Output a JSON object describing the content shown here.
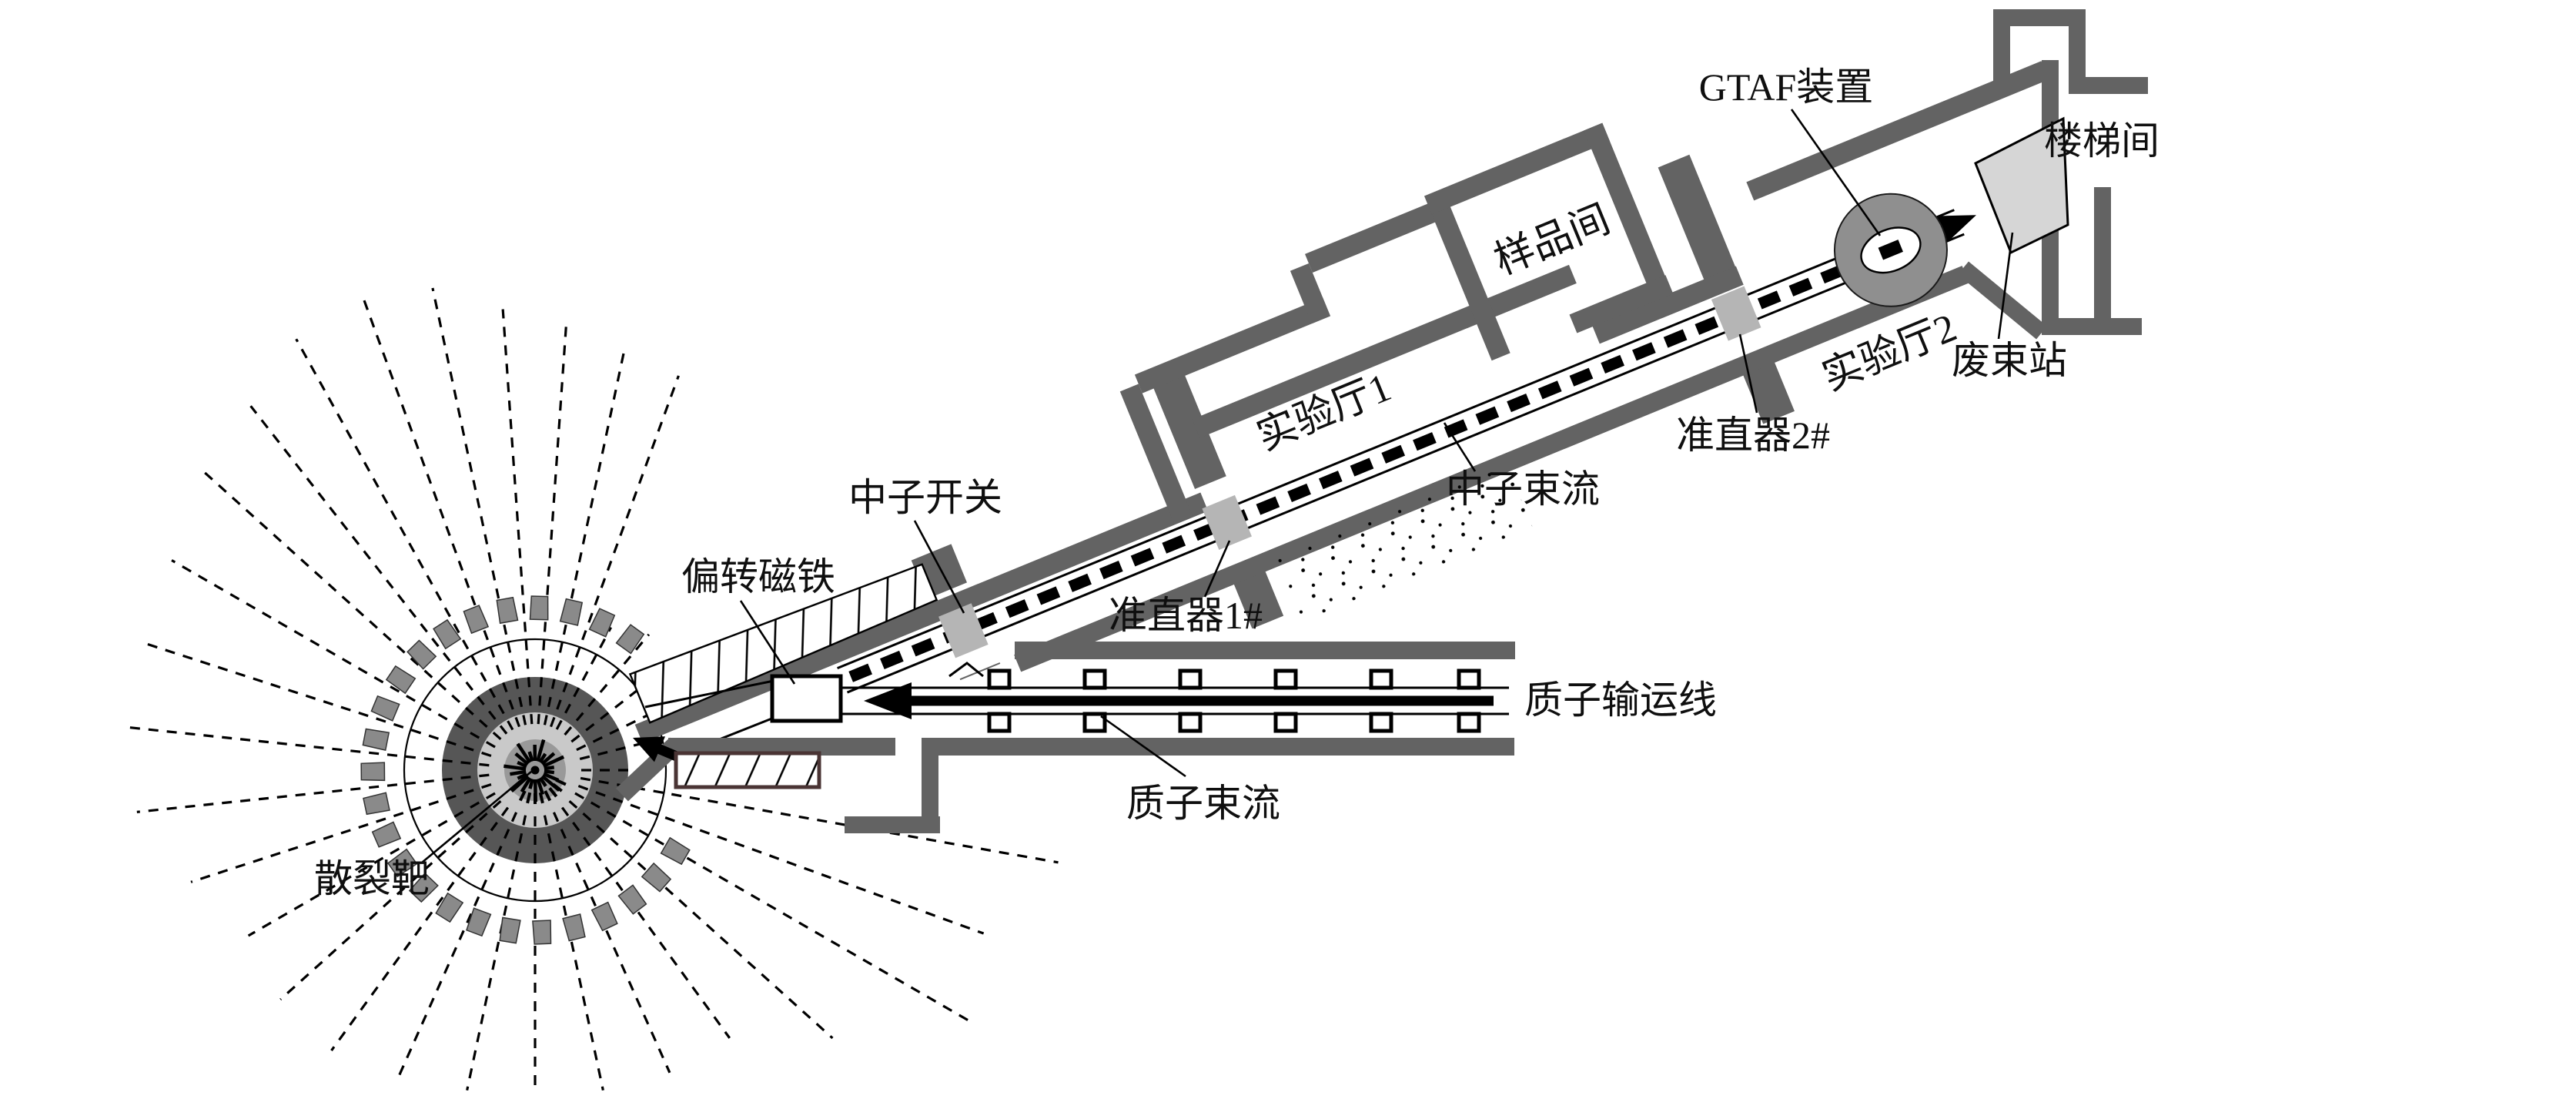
{
  "figure": {
    "description": "Plan layout of a spallation neutron beam facility",
    "beam_angle_deg": -22.3
  },
  "labels": {
    "gtaf_device": {
      "text": "GTAF装置"
    },
    "stairwell": {
      "text": "楼梯间"
    },
    "waste_beam_station": {
      "text": "废束站"
    },
    "sample_room": {
      "text": "样品间"
    },
    "exp_hall_1": {
      "text": "实验厅1"
    },
    "exp_hall_2": {
      "text": "实验厅2"
    },
    "neutron_beam": {
      "text": "中子束流"
    },
    "collimator_2": {
      "text": "准直器2#"
    },
    "collimator_1": {
      "text": "准直器1#"
    },
    "neutron_shutter": {
      "text": "中子开关"
    },
    "bending_magnet": {
      "text": "偏转磁铁"
    },
    "proton_transport_line": {
      "text": "质子输运线"
    },
    "proton_beam": {
      "text": "质子束流"
    },
    "spallation_target": {
      "text": "散裂靶"
    }
  },
  "colors": {
    "wall": "#636363",
    "collimator": "#b5b5b5",
    "gtaf_circle": "#8f8f8f",
    "beam_dump": "#d6d6d6",
    "ring_dark": "#565656",
    "ring_light": "#c9c9c9",
    "ring_core": "#999999",
    "block": "#8a8a8a",
    "hatch_border_lower": "#4a3434",
    "ink": "#0f0f0f"
  },
  "target": {
    "center": [
      695,
      1000
    ],
    "radii": {
      "core": 40,
      "light": 75,
      "dark": 121,
      "outline": 170,
      "block_inner": 196,
      "block_outer": 226
    },
    "block_arc": {
      "start_deg": 30,
      "end_deg": 306,
      "step_deg": 11.5
    },
    "rays": [
      [
        0,
        150
      ],
      [
        10,
        690
      ],
      [
        20,
        620
      ],
      [
        30,
        655
      ],
      [
        42,
        520
      ],
      [
        54,
        430
      ],
      [
        66,
        430
      ],
      [
        78,
        425
      ],
      [
        90,
        420
      ],
      [
        102,
        425
      ],
      [
        114,
        435
      ],
      [
        126,
        450
      ],
      [
        138,
        445
      ],
      [
        150,
        430
      ],
      [
        162,
        470
      ],
      [
        174,
        520
      ],
      [
        186,
        540
      ],
      [
        198,
        530
      ],
      [
        210,
        545
      ],
      [
        222,
        580
      ],
      [
        232,
        600
      ],
      [
        241,
        640
      ],
      [
        250,
        655
      ],
      [
        258,
        640
      ],
      [
        266,
        600
      ],
      [
        274,
        580
      ],
      [
        282,
        560
      ],
      [
        290,
        545
      ],
      [
        298,
        210
      ],
      [
        310,
        230
      ],
      [
        322,
        200
      ],
      [
        334,
        165
      ],
      [
        346,
        148
      ]
    ]
  },
  "proton_line": {
    "magnet_pair_x": [
      1298,
      1422,
      1546,
      1670,
      1794,
      1908
    ]
  }
}
